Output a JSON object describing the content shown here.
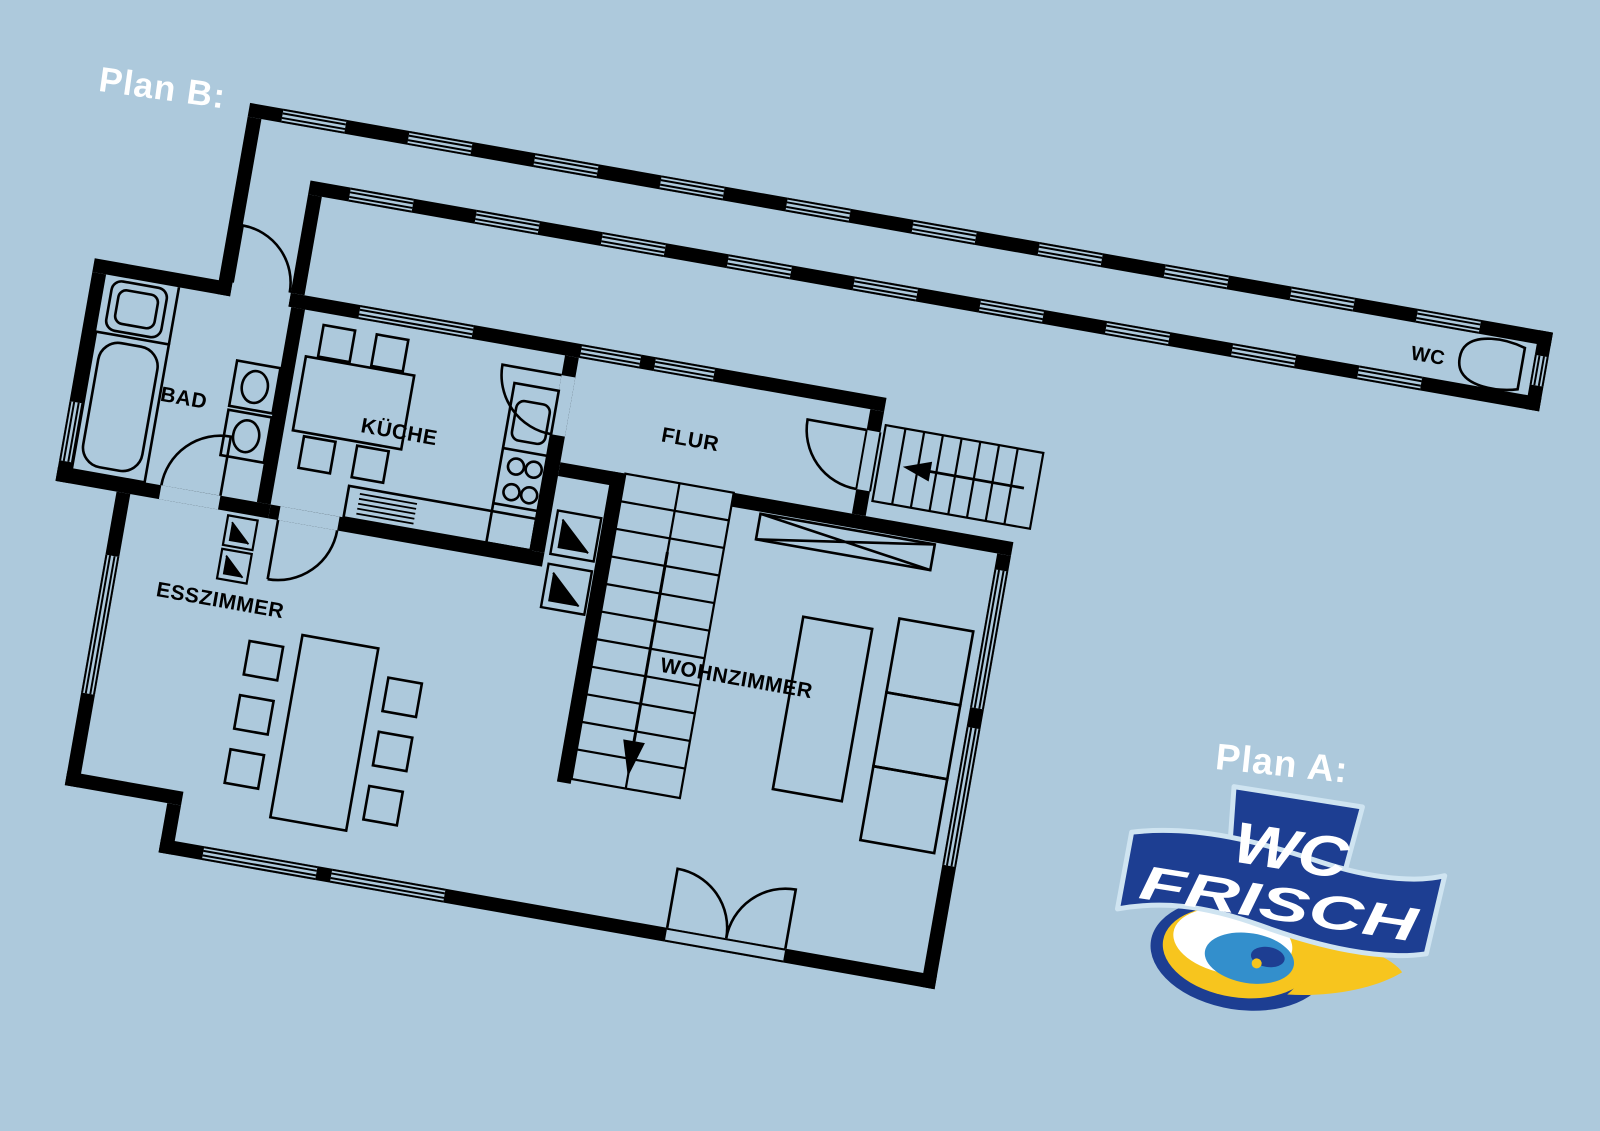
{
  "plan_b": {
    "label": "Plan B:"
  },
  "plan_a": {
    "label": "Plan A:"
  },
  "floor_plan": {
    "rooms": {
      "bad": "BAD",
      "kueche": "KÜCHE",
      "flur": "FLUR",
      "esszimmer": "ESSZIMMER",
      "wohnzimmer": "WOHNZIMMER",
      "wc": "WC"
    }
  },
  "logo": {
    "word1": "WC",
    "word2": "FRISCH"
  },
  "colors": {
    "background": "#adc9dc",
    "walls": "#000000",
    "label_text": "#ffffff",
    "logo_navy": "#1d3e92",
    "logo_blue": "#338fcc",
    "logo_yellow": "#f7c51e",
    "logo_white": "#ffffff"
  }
}
